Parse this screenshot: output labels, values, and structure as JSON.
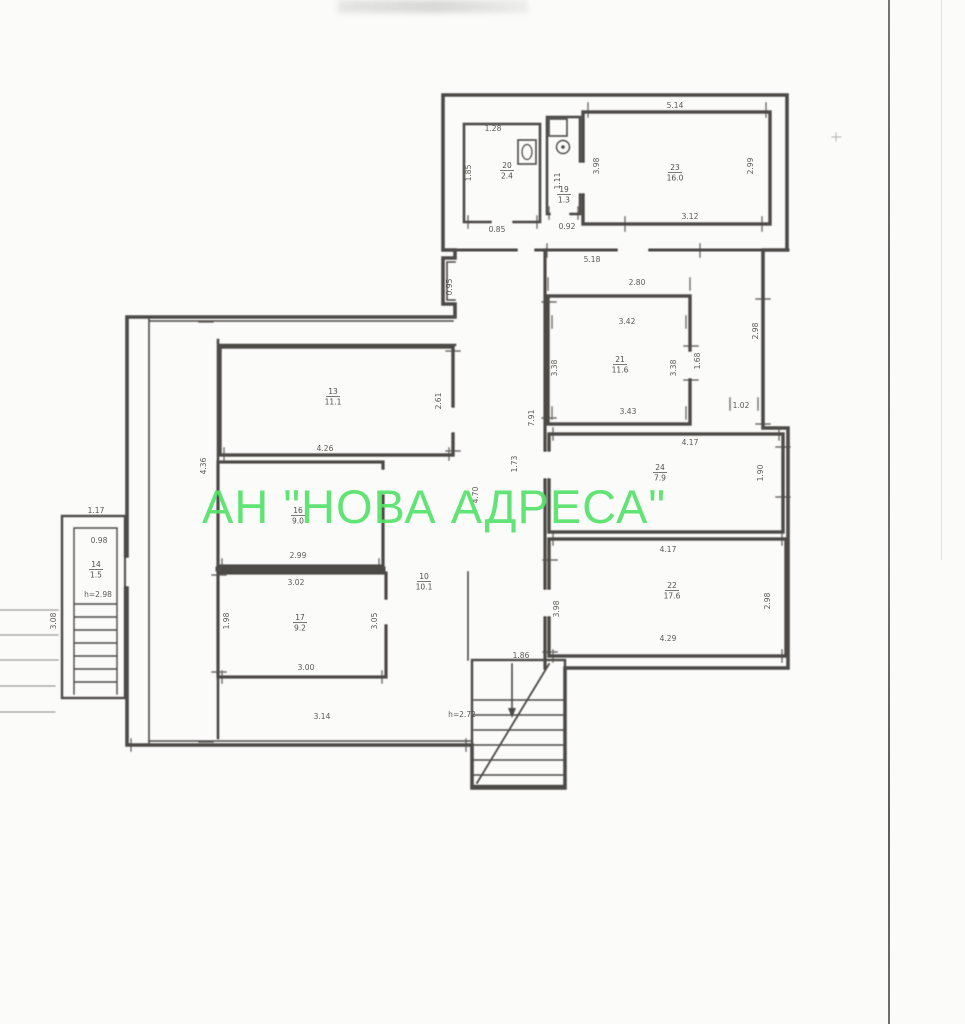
{
  "page": {
    "background": "#fbfbf9"
  },
  "watermark": {
    "text": "АН \"НОВА АДРЕСА\"",
    "color": "#55e26a"
  },
  "plan": {
    "line_color": "#35332f",
    "dims": [
      {
        "t": "1.28",
        "x": 493,
        "y": 131,
        "r": 0
      },
      {
        "t": "1.85",
        "x": 471,
        "y": 173,
        "r": -90
      },
      {
        "t": "0.85",
        "x": 497,
        "y": 232,
        "r": 0
      },
      {
        "t": "0.92",
        "x": 567,
        "y": 229,
        "r": 0
      },
      {
        "t": "1.11",
        "x": 560,
        "y": 181,
        "r": -90
      },
      {
        "t": "5.14",
        "x": 675,
        "y": 108,
        "r": 0
      },
      {
        "t": "3.98",
        "x": 599,
        "y": 166,
        "r": -90
      },
      {
        "t": "2.99",
        "x": 753,
        "y": 166,
        "r": -90
      },
      {
        "t": "3.12",
        "x": 690,
        "y": 219,
        "r": 0
      },
      {
        "t": "5.18",
        "x": 592,
        "y": 262,
        "r": 0
      },
      {
        "t": "2.80",
        "x": 637,
        "y": 285,
        "r": 0
      },
      {
        "t": "3.42",
        "x": 627,
        "y": 324,
        "r": 0
      },
      {
        "t": "3.43",
        "x": 628,
        "y": 414,
        "r": 0
      },
      {
        "t": "3.38",
        "x": 557,
        "y": 368,
        "r": -90
      },
      {
        "t": "3.38",
        "x": 676,
        "y": 368,
        "r": -90
      },
      {
        "t": "1.68",
        "x": 700,
        "y": 361,
        "r": -90
      },
      {
        "t": "2.98",
        "x": 758,
        "y": 331,
        "r": -90
      },
      {
        "t": "1.02",
        "x": 741,
        "y": 408,
        "r": 0
      },
      {
        "t": "4.17",
        "x": 690,
        "y": 445,
        "r": 0
      },
      {
        "t": "1.90",
        "x": 763,
        "y": 473,
        "r": -90
      },
      {
        "t": "4.17",
        "x": 668,
        "y": 552,
        "r": 0
      },
      {
        "t": "4.29",
        "x": 668,
        "y": 641,
        "r": 0
      },
      {
        "t": "3.98",
        "x": 559,
        "y": 609,
        "r": -90
      },
      {
        "t": "2.98",
        "x": 770,
        "y": 601,
        "r": -90
      },
      {
        "t": "0.95",
        "x": 452,
        "y": 287,
        "r": -90
      },
      {
        "t": "7.91",
        "x": 534,
        "y": 418,
        "r": -90
      },
      {
        "t": "1.73",
        "x": 517,
        "y": 464,
        "r": -90
      },
      {
        "t": "4.70",
        "x": 478,
        "y": 495,
        "r": -90
      },
      {
        "t": "4.36",
        "x": 206,
        "y": 466,
        "r": -90
      },
      {
        "t": "4.26",
        "x": 325,
        "y": 451,
        "r": 0
      },
      {
        "t": "2.61",
        "x": 441,
        "y": 401,
        "r": -90
      },
      {
        "t": "2.99",
        "x": 298,
        "y": 558,
        "r": 0
      },
      {
        "t": "3.02",
        "x": 296,
        "y": 585,
        "r": 0
      },
      {
        "t": "3.00",
        "x": 306,
        "y": 670,
        "r": 0
      },
      {
        "t": "1.98",
        "x": 229,
        "y": 621,
        "r": -90
      },
      {
        "t": "3.05",
        "x": 377,
        "y": 621,
        "r": -90
      },
      {
        "t": "3.14",
        "x": 322,
        "y": 719,
        "r": 0
      },
      {
        "t": "h=2.72",
        "x": 462,
        "y": 717,
        "r": 0
      },
      {
        "t": "1.86",
        "x": 521,
        "y": 658,
        "r": 0
      },
      {
        "t": "1.17",
        "x": 96,
        "y": 513,
        "r": 0
      },
      {
        "t": "0.98",
        "x": 99,
        "y": 543,
        "r": 0
      },
      {
        "t": "h=2.98",
        "x": 98,
        "y": 597,
        "r": 0
      },
      {
        "t": "3.08",
        "x": 56,
        "y": 621,
        "r": -90
      }
    ],
    "rooms": [
      {
        "num": "20",
        "area": "2.4",
        "x": 507,
        "y": 168
      },
      {
        "num": "19",
        "area": "1.3",
        "x": 564,
        "y": 192
      },
      {
        "num": "23",
        "area": "16.0",
        "x": 675,
        "y": 170
      },
      {
        "num": "21",
        "area": "11.6",
        "x": 620,
        "y": 362
      },
      {
        "num": "24",
        "area": "7.9",
        "x": 660,
        "y": 470
      },
      {
        "num": "22",
        "area": "17.6",
        "x": 672,
        "y": 588
      },
      {
        "num": "13",
        "area": "11.1",
        "x": 333,
        "y": 394
      },
      {
        "num": "16",
        "area": "9.0",
        "x": 298,
        "y": 513
      },
      {
        "num": "17",
        "area": "9.2",
        "x": 300,
        "y": 620
      },
      {
        "num": "10",
        "area": "10.1",
        "x": 424,
        "y": 579
      },
      {
        "num": "14",
        "area": "1.5",
        "x": 96,
        "y": 567
      }
    ]
  }
}
